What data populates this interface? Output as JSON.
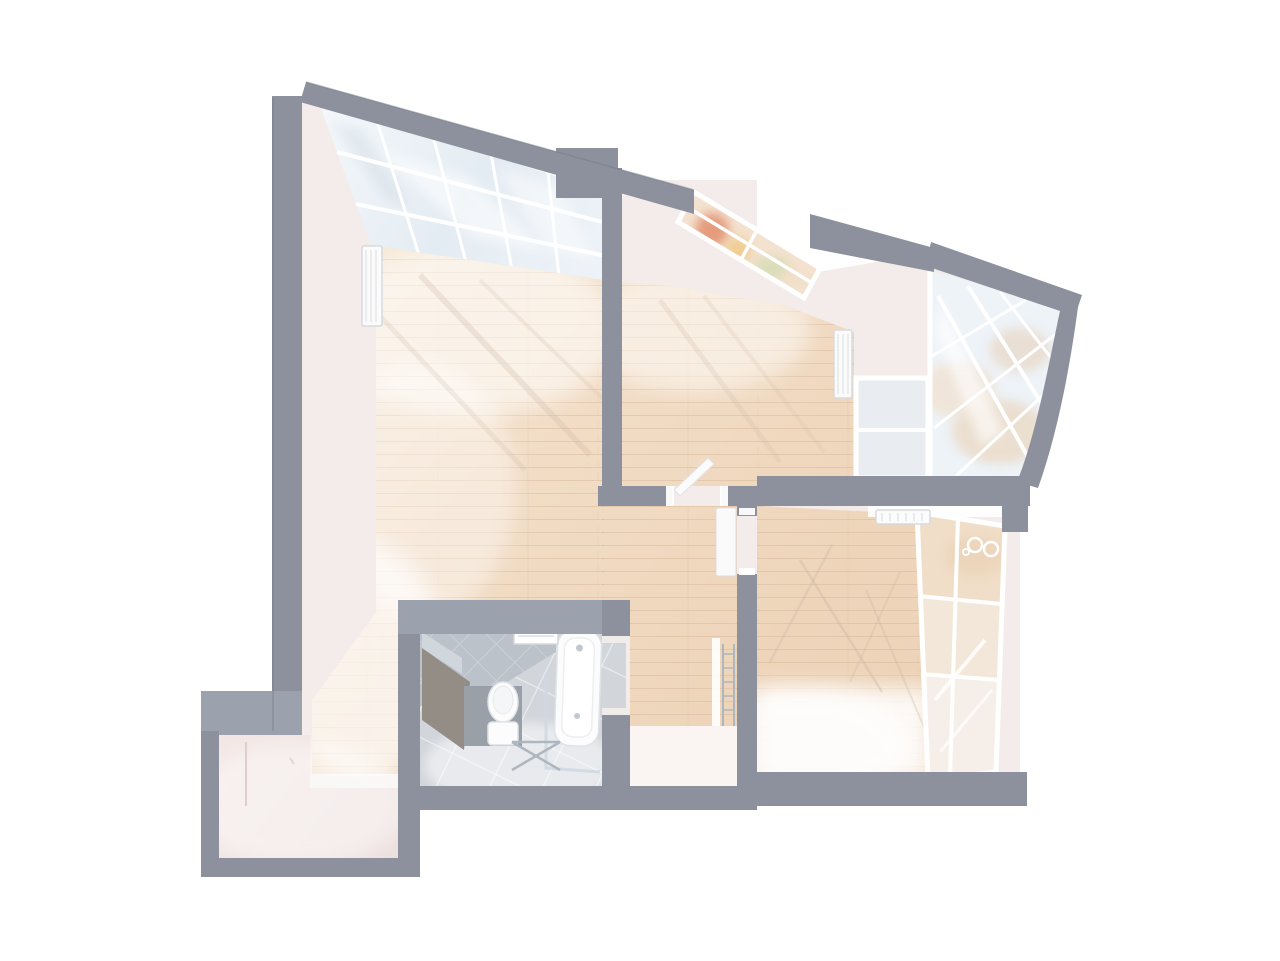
{
  "canvas": {
    "width": 1280,
    "height": 961
  },
  "colors": {
    "background": "#ffffff",
    "wall": "#8c919d",
    "wallLight": "#9ca2ad",
    "wallDark": "#767b87",
    "plaster": "#f4ecea",
    "plasterBright": "#faf5f3",
    "woodLight": "#f8ecdc",
    "woodMid": "#f1dcc4",
    "woodDeep": "#ebd0b3",
    "plankLine": "#d2b293",
    "entryFloor": "#efe2e0",
    "sill": "#f7f3f1",
    "glass": "#edf2f7",
    "glassDeep": "#dfe8f1",
    "mullion": "#ffffff",
    "viewBase": "#f4e2d0",
    "viewPeach": "#e28f6e",
    "viewGold": "#efcb8c",
    "viewGreen": "#d5dcb4",
    "viewWarmWall": "#f0dcc6",
    "tileWall": "#bcc2ca",
    "tileFloor": "#d2d6db",
    "grout": "#e9ecef",
    "fixture": "#fcfcfd",
    "fixtureLine": "#dfe3e8",
    "chrome": "#aeb6bf",
    "counter": "#938d86",
    "carrier": "#99a0a8",
    "mirror": "#cfd7dd",
    "shadowWarm": "#cdb7a4",
    "branchShadow": "#c8b2a2"
  },
  "scene": {
    "type": "3d-rendered-apartment-floor-plan",
    "view": "top-down-dollhouse",
    "rooms": [
      {
        "id": "living-room",
        "floor": "light-wood-parquet",
        "features": [
          "slanted-winter-garden-roof-glazing",
          "wall-radiator",
          "sunlight-washes"
        ]
      },
      {
        "id": "bedroom-north",
        "floor": "light-wood-parquet",
        "features": [
          "slanted-picture-window-autumn-view",
          "wall-radiator",
          "open-door-to-hall",
          "window-to-winter-garden"
        ]
      },
      {
        "id": "winter-garden-east",
        "floor": "not-visible",
        "features": [
          "curved-glazed-conservatory-roof"
        ]
      },
      {
        "id": "bedroom-east",
        "floor": "light-wood-parquet",
        "features": [
          "full-height-glazed-wall",
          "radiator-under-glazing",
          "railing-swirl-ornament-outside",
          "branch-shadows",
          "sunlight-wash"
        ]
      },
      {
        "id": "bathroom",
        "floor": "gray-ceramic-tile",
        "features": [
          "diagonal-wall-tiling",
          "vent-window"
        ]
      },
      {
        "id": "hallway-center",
        "floor": "light-wood-parquet",
        "features": [
          "open-plan-connection"
        ]
      },
      {
        "id": "corridor-south",
        "floor": "light-wood-parquet",
        "features": [
          "towel-ladder-rail",
          "door-frame"
        ]
      },
      {
        "id": "entry-vestibule",
        "floor": "pale-screed",
        "features": [
          "stepped-alcove",
          "faint-door-outline"
        ]
      }
    ],
    "fixtures": [
      {
        "id": "toilet",
        "room": "bathroom"
      },
      {
        "id": "bathtub",
        "room": "bathroom"
      },
      {
        "id": "shower-glass-screen",
        "room": "bathroom"
      },
      {
        "id": "towel-rack",
        "room": "bathroom"
      },
      {
        "id": "vanity-counter",
        "room": "bathroom"
      },
      {
        "id": "mirror",
        "room": "bathroom"
      },
      {
        "id": "toilet-carrier-halfwall",
        "room": "bathroom"
      },
      {
        "id": "radiator",
        "room": "living-room"
      },
      {
        "id": "radiator",
        "room": "bedroom-north"
      },
      {
        "id": "radiator",
        "room": "bedroom-east"
      },
      {
        "id": "open-door-leaf",
        "room": "bedroom-north"
      },
      {
        "id": "open-door-leaf",
        "room": "hallway-center"
      },
      {
        "id": "towel-ladder",
        "room": "corridor-south"
      }
    ],
    "glazing": [
      {
        "id": "winter-garden-roof-northwest",
        "panes": "grid-in-perspective"
      },
      {
        "id": "bedroom-north-window",
        "panes": 4
      },
      {
        "id": "winter-garden-east-roof",
        "panes": "diagonal-grid"
      },
      {
        "id": "bedroom-east-glazed-wall",
        "panes": 6
      },
      {
        "id": "bedroom-to-winter-garden-window",
        "panes": 2
      }
    ]
  }
}
